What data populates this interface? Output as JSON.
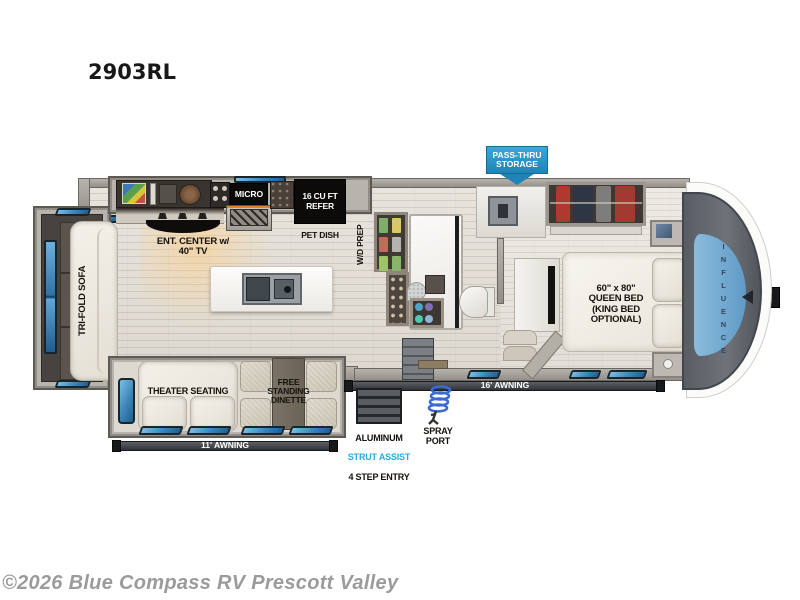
{
  "title": "2903RL",
  "watermark": "©2026 Blue Compass RV Prescott Valley",
  "floorplan": {
    "brand_vertical": "INFLUENCE",
    "labels": {
      "ent_center": "ENT. CENTER w/\n40\" TV",
      "micro": "MICRO",
      "refer": "16 CU FT\nREFER",
      "pet_dish": "PET DISH",
      "wd_prep": "W/D PREP",
      "tri_fold_sofa": "TRI-FOLD SOFA",
      "theater_seating": "THEATER SEATING",
      "dinette": "FREE\nSTANDING\nDINETTE",
      "queen_bed": "60\" x 80\"\nQUEEN BED\n(KING BED\nOPTIONAL)",
      "awning_11": "11' AWNING",
      "awning_16": "16' AWNING"
    },
    "callouts": {
      "pass_thru": "PASS-THRU\nSTORAGE",
      "spray_port": "SPRAY\nPORT",
      "steps_line1": "ALUMINUM",
      "steps_line2": "STRUT ASSIST",
      "steps_line3": "4 STEP ENTRY"
    },
    "colors": {
      "accent_blue": "#29abe2",
      "callout_blue": "#2e9fd4",
      "window_blue": "#3d85b8",
      "awning_bar": "#33373b"
    }
  }
}
